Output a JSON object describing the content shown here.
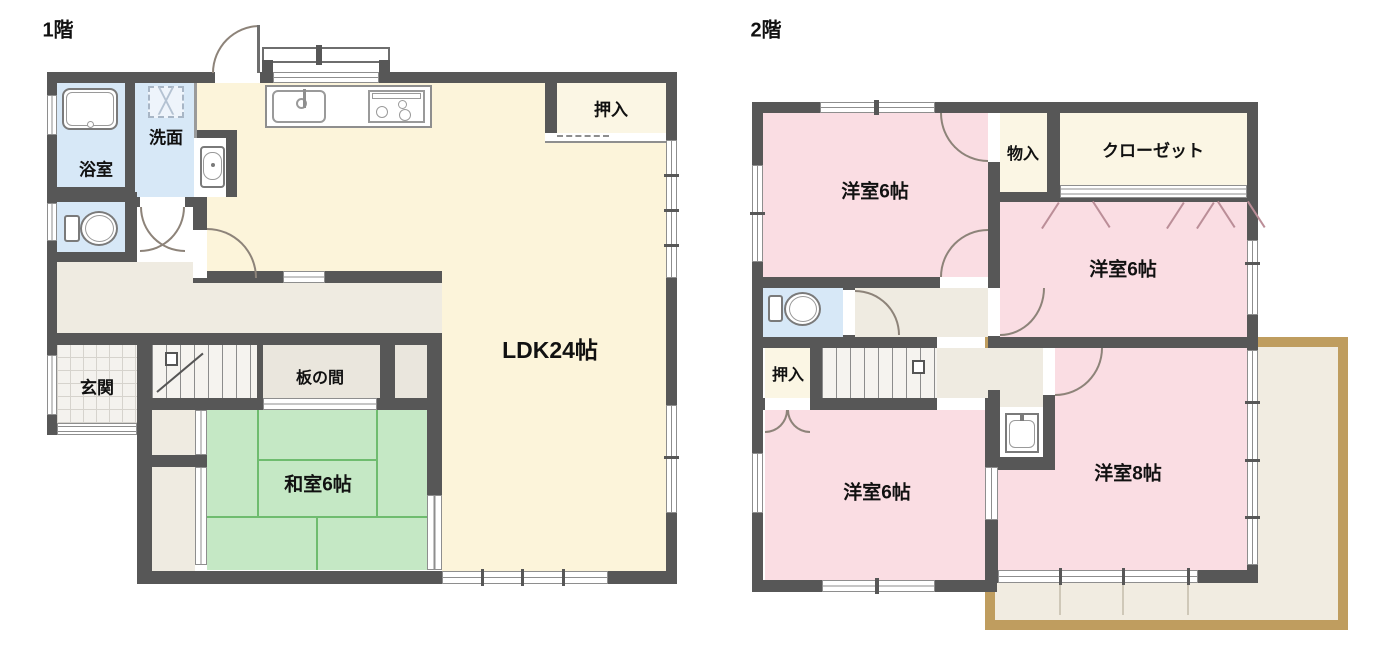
{
  "floors": [
    {
      "id": "floor1",
      "label": "1階",
      "rooms": {
        "bath": "浴室",
        "washroom": "洗面",
        "closet": "押入",
        "ldk": "LDK24帖",
        "entrance": "玄関",
        "itanoma": "板の間",
        "washitsu": "和室6帖"
      }
    },
    {
      "id": "floor2",
      "label": "2階",
      "rooms": {
        "roomA": "洋室6帖",
        "storage": "物入",
        "closet": "クローゼット",
        "roomB": "洋室6帖",
        "oshiire": "押入",
        "roomC": "洋室6帖",
        "roomD": "洋室8帖"
      }
    }
  ],
  "colors": {
    "wall": "#575757",
    "ldk_cream": "#fcf4da",
    "closet_cream": "#fbf6e4",
    "wet_blue": "#d7e8f7",
    "hall_beige": "#efebe1",
    "tatami_green": "#c5e8c5",
    "tatami_line": "#6fbc6f",
    "bedroom_pink": "#fadde3",
    "balcony_border": "#bf9d5f",
    "balcony_fill": "#f1ece1",
    "door_arc": "#8d8379"
  }
}
